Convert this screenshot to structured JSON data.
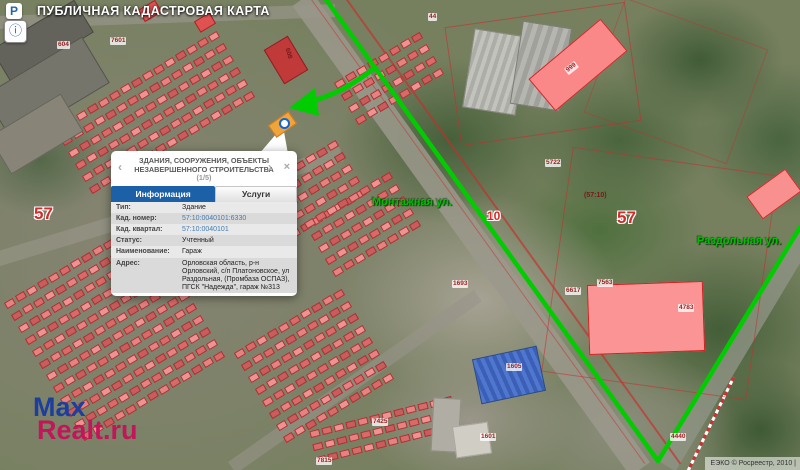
{
  "header": {
    "title": "ПУБЛИЧНАЯ КАДАСТРОВАЯ КАРТА",
    "logo_letter": "Р"
  },
  "toolbar": {
    "info_button_glyph": "ⓘ"
  },
  "popup": {
    "title": "ЗДАНИЯ, СООРУЖЕНИЯ, ОБЪЕКТЫ НЕЗАВЕРШЕННОГО СТРОИТЕЛЬСТВА",
    "pager": "(1/5)",
    "prev": "‹",
    "next": "›",
    "close": "×",
    "tabs": [
      {
        "label": "Информация",
        "active": true
      },
      {
        "label": "Услуги",
        "active": false
      }
    ],
    "fields": [
      {
        "label": "Тип:",
        "value": "Здание",
        "link": false
      },
      {
        "label": "Кад. номер:",
        "value": "57:10:0040101:6330",
        "link": true
      },
      {
        "label": "Кад. квартал:",
        "value": "57:10:0040101",
        "link": true
      },
      {
        "label": "Статус:",
        "value": "Учтенный",
        "link": false
      },
      {
        "label": "Наименование:",
        "value": "Гараж",
        "link": false
      },
      {
        "label": "Адрес:",
        "value": "Орловская область, р-н Орловский, с/п Платоновское, ул Раздольная, (Промбаза ОСПАЗ), ПГСК \"Надежда\", гараж №313",
        "link": false
      }
    ]
  },
  "map": {
    "street_labels": [
      "Монтажная ул.",
      "Раздольная ул."
    ],
    "region_code_labels": [
      "57",
      "10",
      "57"
    ],
    "quarter_label": "(57:10)",
    "parcel_labels": [
      "604",
      "7601",
      "44",
      "999",
      "5722",
      "1693",
      "6617",
      "7563",
      "4783",
      "1605",
      "7425",
      "1601",
      "4440",
      "7815",
      "608"
    ],
    "colors": {
      "route_green": "#00cc00",
      "parcel_line_red": "#cc2a2a",
      "selected_highlight_orange": "#efa53c",
      "accent_blue": "#1c60a8"
    }
  },
  "watermark": {
    "line1": "Max",
    "line2": "Realt.ru"
  },
  "attribution": "ЕЭКО © Росреестр, 2010 |"
}
